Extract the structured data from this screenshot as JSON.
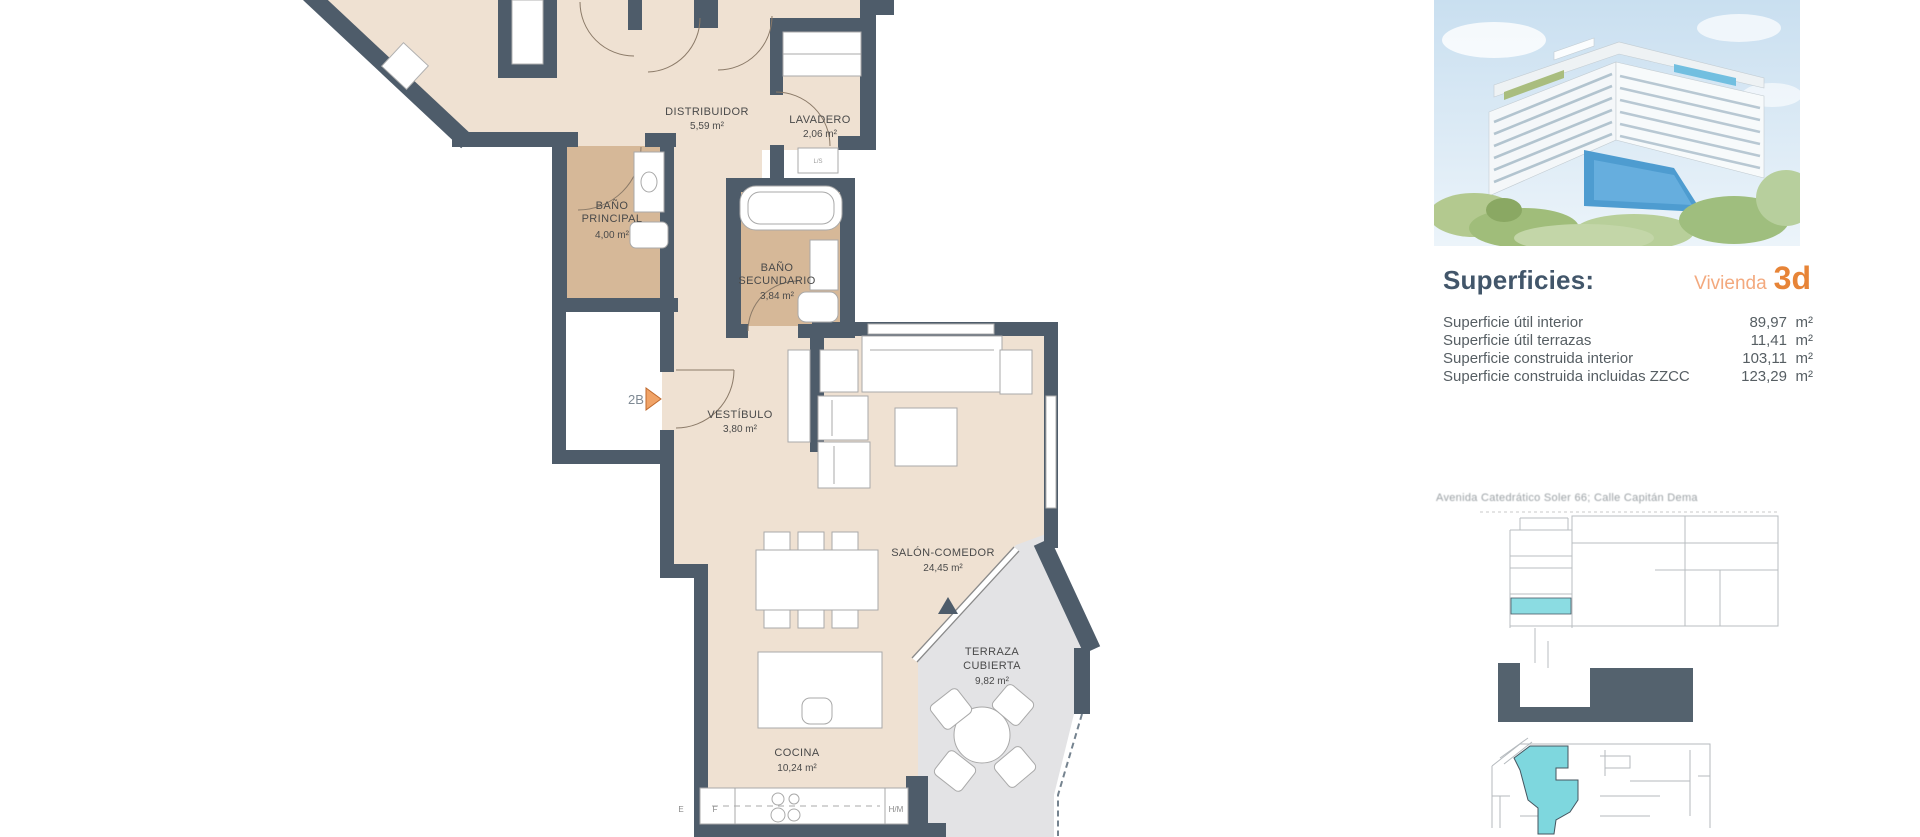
{
  "plan": {
    "unit_marker": "2B",
    "rooms": {
      "distribuidor": {
        "name": "DISTRIBUIDOR",
        "area": "5,59 m²"
      },
      "lavadero": {
        "name": "LAVADERO",
        "area": "2,06 m²"
      },
      "bano_principal": {
        "name1": "BAÑO",
        "name2": "PRINCIPAL",
        "area": "4,00 m²"
      },
      "bano_secundario": {
        "name1": "BAÑO",
        "name2": "SECUNDARIO",
        "area": "3,84 m²"
      },
      "vestibulo": {
        "name": "VESTÍBULO",
        "area": "3,80 m²"
      },
      "salon": {
        "name": "SALÓN-COMEDOR",
        "area": "24,45 m²"
      },
      "terraza": {
        "name1": "TERRAZA",
        "name2": "CUBIERTA",
        "area": "9,82 m²"
      },
      "cocina": {
        "name": "COCINA",
        "area": "10,24 m²"
      }
    },
    "kitchen_labels": {
      "e": "E",
      "f": "F",
      "hm": "H/M"
    },
    "appliance_label": "L/S"
  },
  "panel": {
    "title": "Superficies:",
    "vivienda_label": "Vivienda",
    "vivienda_number": "3d",
    "rows": [
      {
        "label": "Superficie útil interior",
        "value": "89,97",
        "unit": "m²"
      },
      {
        "label": "Superficie útil terrazas",
        "value": "11,41",
        "unit": "m²"
      },
      {
        "label": "Superficie construida interior",
        "value": "103,11",
        "unit": "m²"
      },
      {
        "label": "Superficie construida incluidas ZZCC",
        "value": "123,29",
        "unit": "m²"
      }
    ],
    "address": "Avenida Catedrático Soler 66; Calle Capitán Dema"
  },
  "colors": {
    "wall": "#4e5c6a",
    "floor": "#efe1d2",
    "bath_floor": "#d6b898",
    "terrace_floor": "#e3e3e5",
    "accent_orange": "#e78437",
    "highlight_cyan": "#7ed7de"
  }
}
